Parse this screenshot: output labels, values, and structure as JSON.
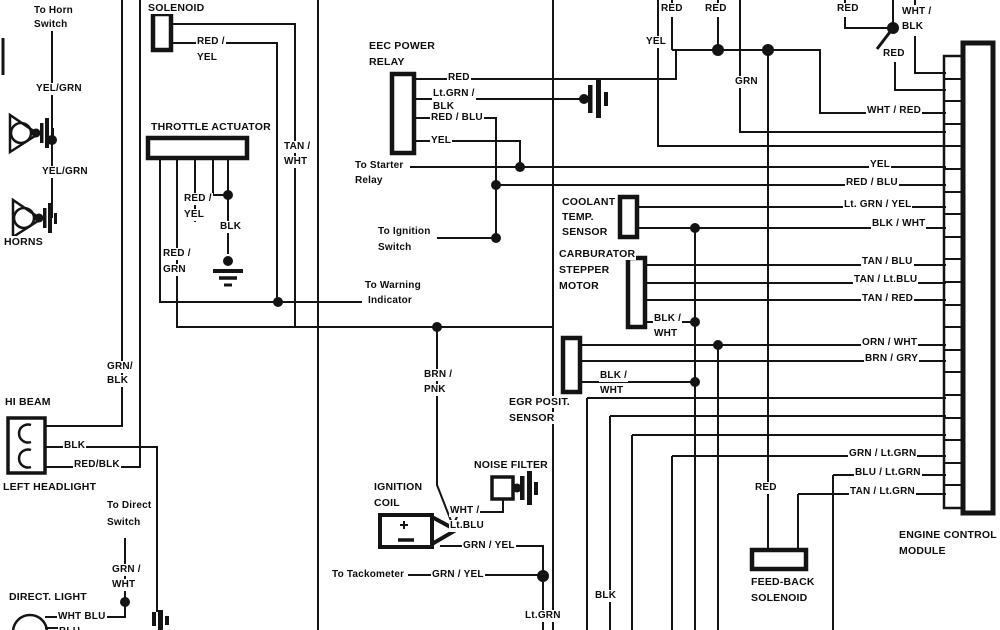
{
  "diagram_type": "automotive-wiring-diagram",
  "colors": {
    "background": "#ffffff",
    "line": "#141414"
  },
  "components": {
    "horns": "HORNS",
    "left_headlight": "LEFT HEADLIGHT",
    "direct_light": "DIRECT. LIGHT",
    "solenoid": "SOLENOID",
    "throttle_actuator": "THROTTLE ACTUATOR",
    "eec_power_relay_1": "EEC POWER",
    "eec_power_relay_2": "RELAY",
    "coolant_1": "COOLANT",
    "coolant_2": "TEMP.",
    "coolant_3": "SENSOR",
    "carb_1": "CARBURATOR",
    "carb_2": "STEPPER",
    "carb_3": "MOTOR",
    "egr_1": "EGR POSIT.",
    "egr_2": "SENSOR",
    "noise_filter": "NOISE FILTER",
    "ignition_1": "IGNITION",
    "ignition_2": "COIL",
    "feedback_1": "FEED-BACK",
    "feedback_2": "SOLENOID",
    "ecm_1": "ENGINE CONTROL",
    "ecm_2": "MODULE",
    "hi_beam": "HI BEAM"
  },
  "labels": {
    "to_horn_1": "To Horn",
    "to_horn_2": "Switch",
    "yel_grn_1": "YEL/GRN",
    "yel_grn_2": "YEL/GRN",
    "blk_headlight": "BLK",
    "red_blk": "RED/BLK",
    "grn_blk_1": "GRN/",
    "grn_blk_2": "BLK",
    "to_direct_1": "To Direct",
    "to_direct_2": "Switch",
    "grn_wht_1": "GRN /",
    "grn_wht_2": "WHT",
    "wht_blu": "WHT BLU",
    "blu": "BLU",
    "solenoid_red_yel_1": "RED /",
    "solenoid_red_yel_2": "YEL",
    "tan_wht_1": "TAN /",
    "tan_wht_2": "WHT",
    "ta_red_yel_1": "RED /",
    "ta_red_yel_2": "YEL",
    "ta_blk": "BLK",
    "red_grn_1": "RED /",
    "red_grn_2": "GRN",
    "relay_red": "RED",
    "relay_ltgrn_blk_1": "Lt.GRN /",
    "relay_ltgrn_blk_2": "BLK",
    "relay_red_blu": "RED / BLU",
    "relay_yel": "YEL",
    "to_starter_1": "To Starter",
    "to_starter_2": "Relay",
    "to_ignition_1": "To Ignition",
    "to_ignition_2": "Switch",
    "to_warning_1": "To Warning",
    "to_warning_2": "Indicator",
    "step_blk_wht_1": "BLK /",
    "step_blk_wht_2": "WHT",
    "egr_blk_wht_1": "BLK /",
    "egr_blk_wht_2": "WHT",
    "brn_pnk_1": "BRN /",
    "brn_pnk_2": "PNK",
    "wht_ltblu_1": "WHT /",
    "wht_ltblu_2": "Lt.BLU",
    "grn_yel_coil": "GRN / YEL",
    "to_tackometer": "To Tackometer",
    "grn_yel_tack": "GRN / YEL",
    "lt_grn": "Lt.GRN",
    "blk_bottom": "BLK",
    "red_top1": "RED",
    "red_top2": "RED",
    "yel_top": "YEL",
    "grn_top": "GRN",
    "red_top3": "RED",
    "wht_blk_1": "WHT /",
    "wht_blk_2": "BLK",
    "red_top4": "RED",
    "wht_red": "WHT / RED",
    "yel_ecm": "YEL",
    "red_blu_ecm": "RED / BLU",
    "ltgrn_yel_ecm": "Lt. GRN / YEL",
    "blk_wht_ecm": "BLK / WHT",
    "tan_blu": "TAN / BLU",
    "tan_ltblu": "TAN / Lt.BLU",
    "tan_red": "TAN / RED",
    "orn_wht": "ORN / WHT",
    "brn_gry": "BRN / GRY",
    "grn_ltgrn": "GRN / Lt.GRN",
    "blu_ltgrn": "BLU / Lt.GRN",
    "tan_ltgrn": "TAN / Lt.GRN",
    "red_feedback": "RED"
  }
}
